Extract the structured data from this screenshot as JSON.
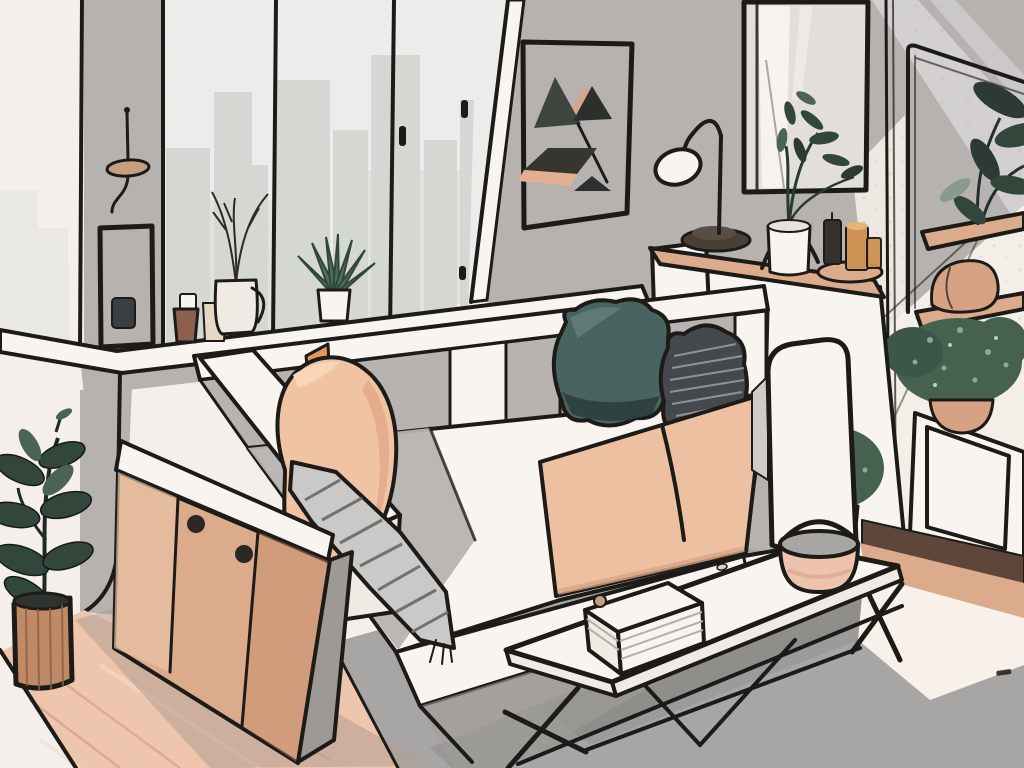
{
  "scene": {
    "title": "Minimalist living room illustration with black ink outlines",
    "style": "flat vector illustration, isometric view, warm neutral palette",
    "objects": [
      {
        "name": "window",
        "label": "Large window with city skyline silhouette"
      },
      {
        "name": "windowsill",
        "label": "White windowsill ledge wrapping the corner"
      },
      {
        "name": "hanging-mobile",
        "label": "Hanging disc mobile on wall pillar"
      },
      {
        "name": "hanging-frame",
        "label": "Small hanging frame with dark cup"
      },
      {
        "name": "windowsill-succulent",
        "label": "Succulent in white pot"
      },
      {
        "name": "windowsill-branch-vase",
        "label": "Ceramic vase with bare branches"
      },
      {
        "name": "windowsill-mug",
        "label": "White mug"
      },
      {
        "name": "windowsill-pot",
        "label": "Small brown plant pot"
      },
      {
        "name": "art-frame",
        "label": "Abstract triangle art in black frame"
      },
      {
        "name": "mirror",
        "label": "Black framed wall mirror"
      },
      {
        "name": "desk-lamp",
        "label": "Arc desk lamp with white shade"
      },
      {
        "name": "console-ledge",
        "label": "Wooden console ledge behind sofa"
      },
      {
        "name": "console-vase-plant",
        "label": "White vase with leafy stems under metal arch"
      },
      {
        "name": "candles",
        "label": "Amber glass candles on wooden tray"
      },
      {
        "name": "sofa",
        "label": "Sectional sofa with panel upholstery"
      },
      {
        "name": "peach-pillow",
        "label": "Large peach pillow"
      },
      {
        "name": "teal-pillow",
        "label": "Dark teal pillow"
      },
      {
        "name": "striped-pillow",
        "label": "Dark gray striped pillow"
      },
      {
        "name": "throw-blanket",
        "label": "Gray striped throw over armrest"
      },
      {
        "name": "seat-cushions",
        "label": "Peach seat cushions"
      },
      {
        "name": "sideboard",
        "label": "Wooden sideboard with round knobs"
      },
      {
        "name": "floor-plant",
        "label": "Rubber plant in slatted wooden pot"
      },
      {
        "name": "coffee-table",
        "label": "White coffee table with wire legs"
      },
      {
        "name": "book-box",
        "label": "Stack of books on table"
      },
      {
        "name": "bowl",
        "label": "Pink bowl with arc handle"
      },
      {
        "name": "rug",
        "label": "Gray area rug"
      },
      {
        "name": "wood-floor",
        "label": "Warm wooden floor"
      },
      {
        "name": "wall-shelves",
        "label": "Wooden wall shelves"
      },
      {
        "name": "shelf-plant",
        "label": "Dark leafy plant on top shelf"
      },
      {
        "name": "terracotta-ornament",
        "label": "Terracotta ornament on shelf"
      },
      {
        "name": "bushy-plant",
        "label": "Bushy plant in terracotta pot on white cabinet"
      },
      {
        "name": "white-cabinet",
        "label": "White paneled cabinet"
      },
      {
        "name": "plant-stand",
        "label": "Small potted plant on black stand"
      }
    ]
  },
  "palette": {
    "ink": "#1d1b18",
    "bg": "#f4efeb",
    "wall": "#b5b2af",
    "glass": "#ecedea",
    "skyline": "#d5d7d2",
    "skyline-light": "#e1e2dd",
    "white": "#f8f4f0",
    "white-soft": "#efeae4",
    "sunlit": "#f7f1ea",
    "wood": "#dcab8c",
    "wood-dark": "#c08a66",
    "cab-side": "#9d9a96",
    "floor-wood": "#eec6ad",
    "floor-streak": "#d9a184",
    "floor-streak-light": "#f7dcc9",
    "floor-shadow": "#b39d90",
    "rug": "#a8a6a4",
    "shadow-gray": "#a09d9a",
    "sofa-gray": "#b6b3b0",
    "seat-peach": "#ecc0a1",
    "seat-peach-dark": "#d8a585",
    "pillow-peach": "#f0c3a3",
    "pillow-peach-dark": "#e2ab8a",
    "pillow-fold": "#f7d6ba",
    "accent-orange": "#e8955c",
    "amber-line": "#e08a4e",
    "teal": "#486360",
    "teal-dark": "#2b3f3c",
    "teal-light": "#64807b",
    "pillow-gray": "#45494e",
    "stripe-light": "#9aa0a5",
    "throw": "#cbc9c7",
    "throw-stripe": "#717171",
    "leaf-dark": "#33463c",
    "leaf-darker": "#2c3a33",
    "leaf-mid": "#4b6354",
    "leaf-light": "#8b9a90",
    "succulent": "#4e6e5f",
    "bush": "#46624f",
    "bush-dark": "#3c5747",
    "bush-light": "#93b29c",
    "terracotta": "#d7a284",
    "clay": "#8d5f4e",
    "jug": "#e7d8c6",
    "amber": "#cd9154",
    "amber-light": "#e7b377",
    "candle-dark": "#33322e",
    "lamp-base": "#4a3f36",
    "mirror-glass": "#e2ded9",
    "band-dark": "#5f463a",
    "soil": "#2e332f",
    "knob": "#2b2723",
    "dot": "#e59a92",
    "art-dark": "#3e443e",
    "art-darker": "#2d2f2d",
    "art-olive": "#34362f",
    "art-peach": "#d8a58c",
    "art-band": "#e2b091",
    "disc": "#c79e80",
    "dark-object": "#3b3f43",
    "stand-pot": "#cdbbaa",
    "page-line": "#b5b0a9",
    "book-knob": "#c9a07e",
    "crumb": "#d8cfc6",
    "bowl-top": "#a9a7a4",
    "bowl": "#eec3ad"
  }
}
